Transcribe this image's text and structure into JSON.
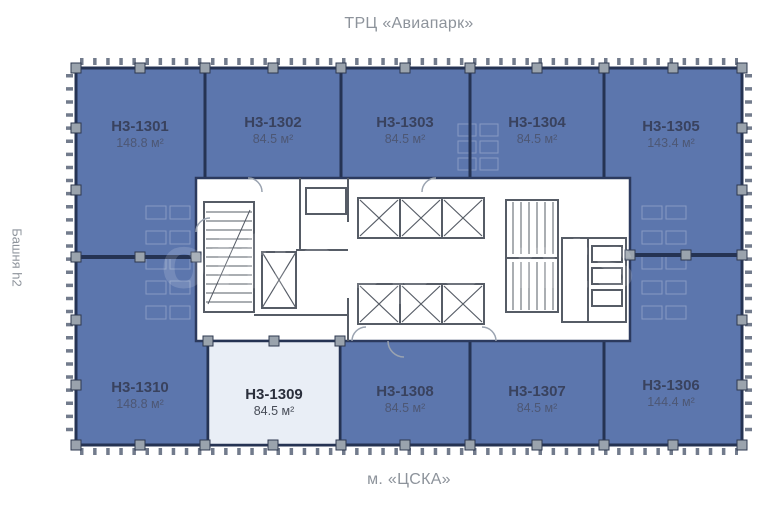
{
  "titles": {
    "top": "ТРЦ «Авиапарк»",
    "bottom": "м. «ЦСКА»",
    "side": "Башня h2"
  },
  "watermark": "officepoints",
  "colors": {
    "unit_fill": "#5c76ad",
    "unit_wall": "#253353",
    "highlight_fill": "#e9eef6",
    "core_fill": "#ffffff",
    "core_wall": "#565c66",
    "column_fill": "#9aa3ad",
    "tick_color": "#5a6478",
    "muted_text": "#8d939b",
    "unit_label": "#39425e"
  },
  "units": [
    {
      "id": "H3-1301",
      "area": "148.8 м²",
      "highlighted": false
    },
    {
      "id": "H3-1302",
      "area": "84.5 м²",
      "highlighted": false
    },
    {
      "id": "H3-1303",
      "area": "84.5 м²",
      "highlighted": false
    },
    {
      "id": "H3-1304",
      "area": "84.5 м²",
      "highlighted": false
    },
    {
      "id": "H3-1305",
      "area": "143.4 м²",
      "highlighted": false
    },
    {
      "id": "H3-1306",
      "area": "144.4 м²",
      "highlighted": false
    },
    {
      "id": "H3-1307",
      "area": "84.5 м²",
      "highlighted": false
    },
    {
      "id": "H3-1308",
      "area": "84.5 м²",
      "highlighted": false
    },
    {
      "id": "H3-1309",
      "area": "84.5 м²",
      "highlighted": true
    },
    {
      "id": "H3-1310",
      "area": "148.8 м²",
      "highlighted": false
    }
  ]
}
